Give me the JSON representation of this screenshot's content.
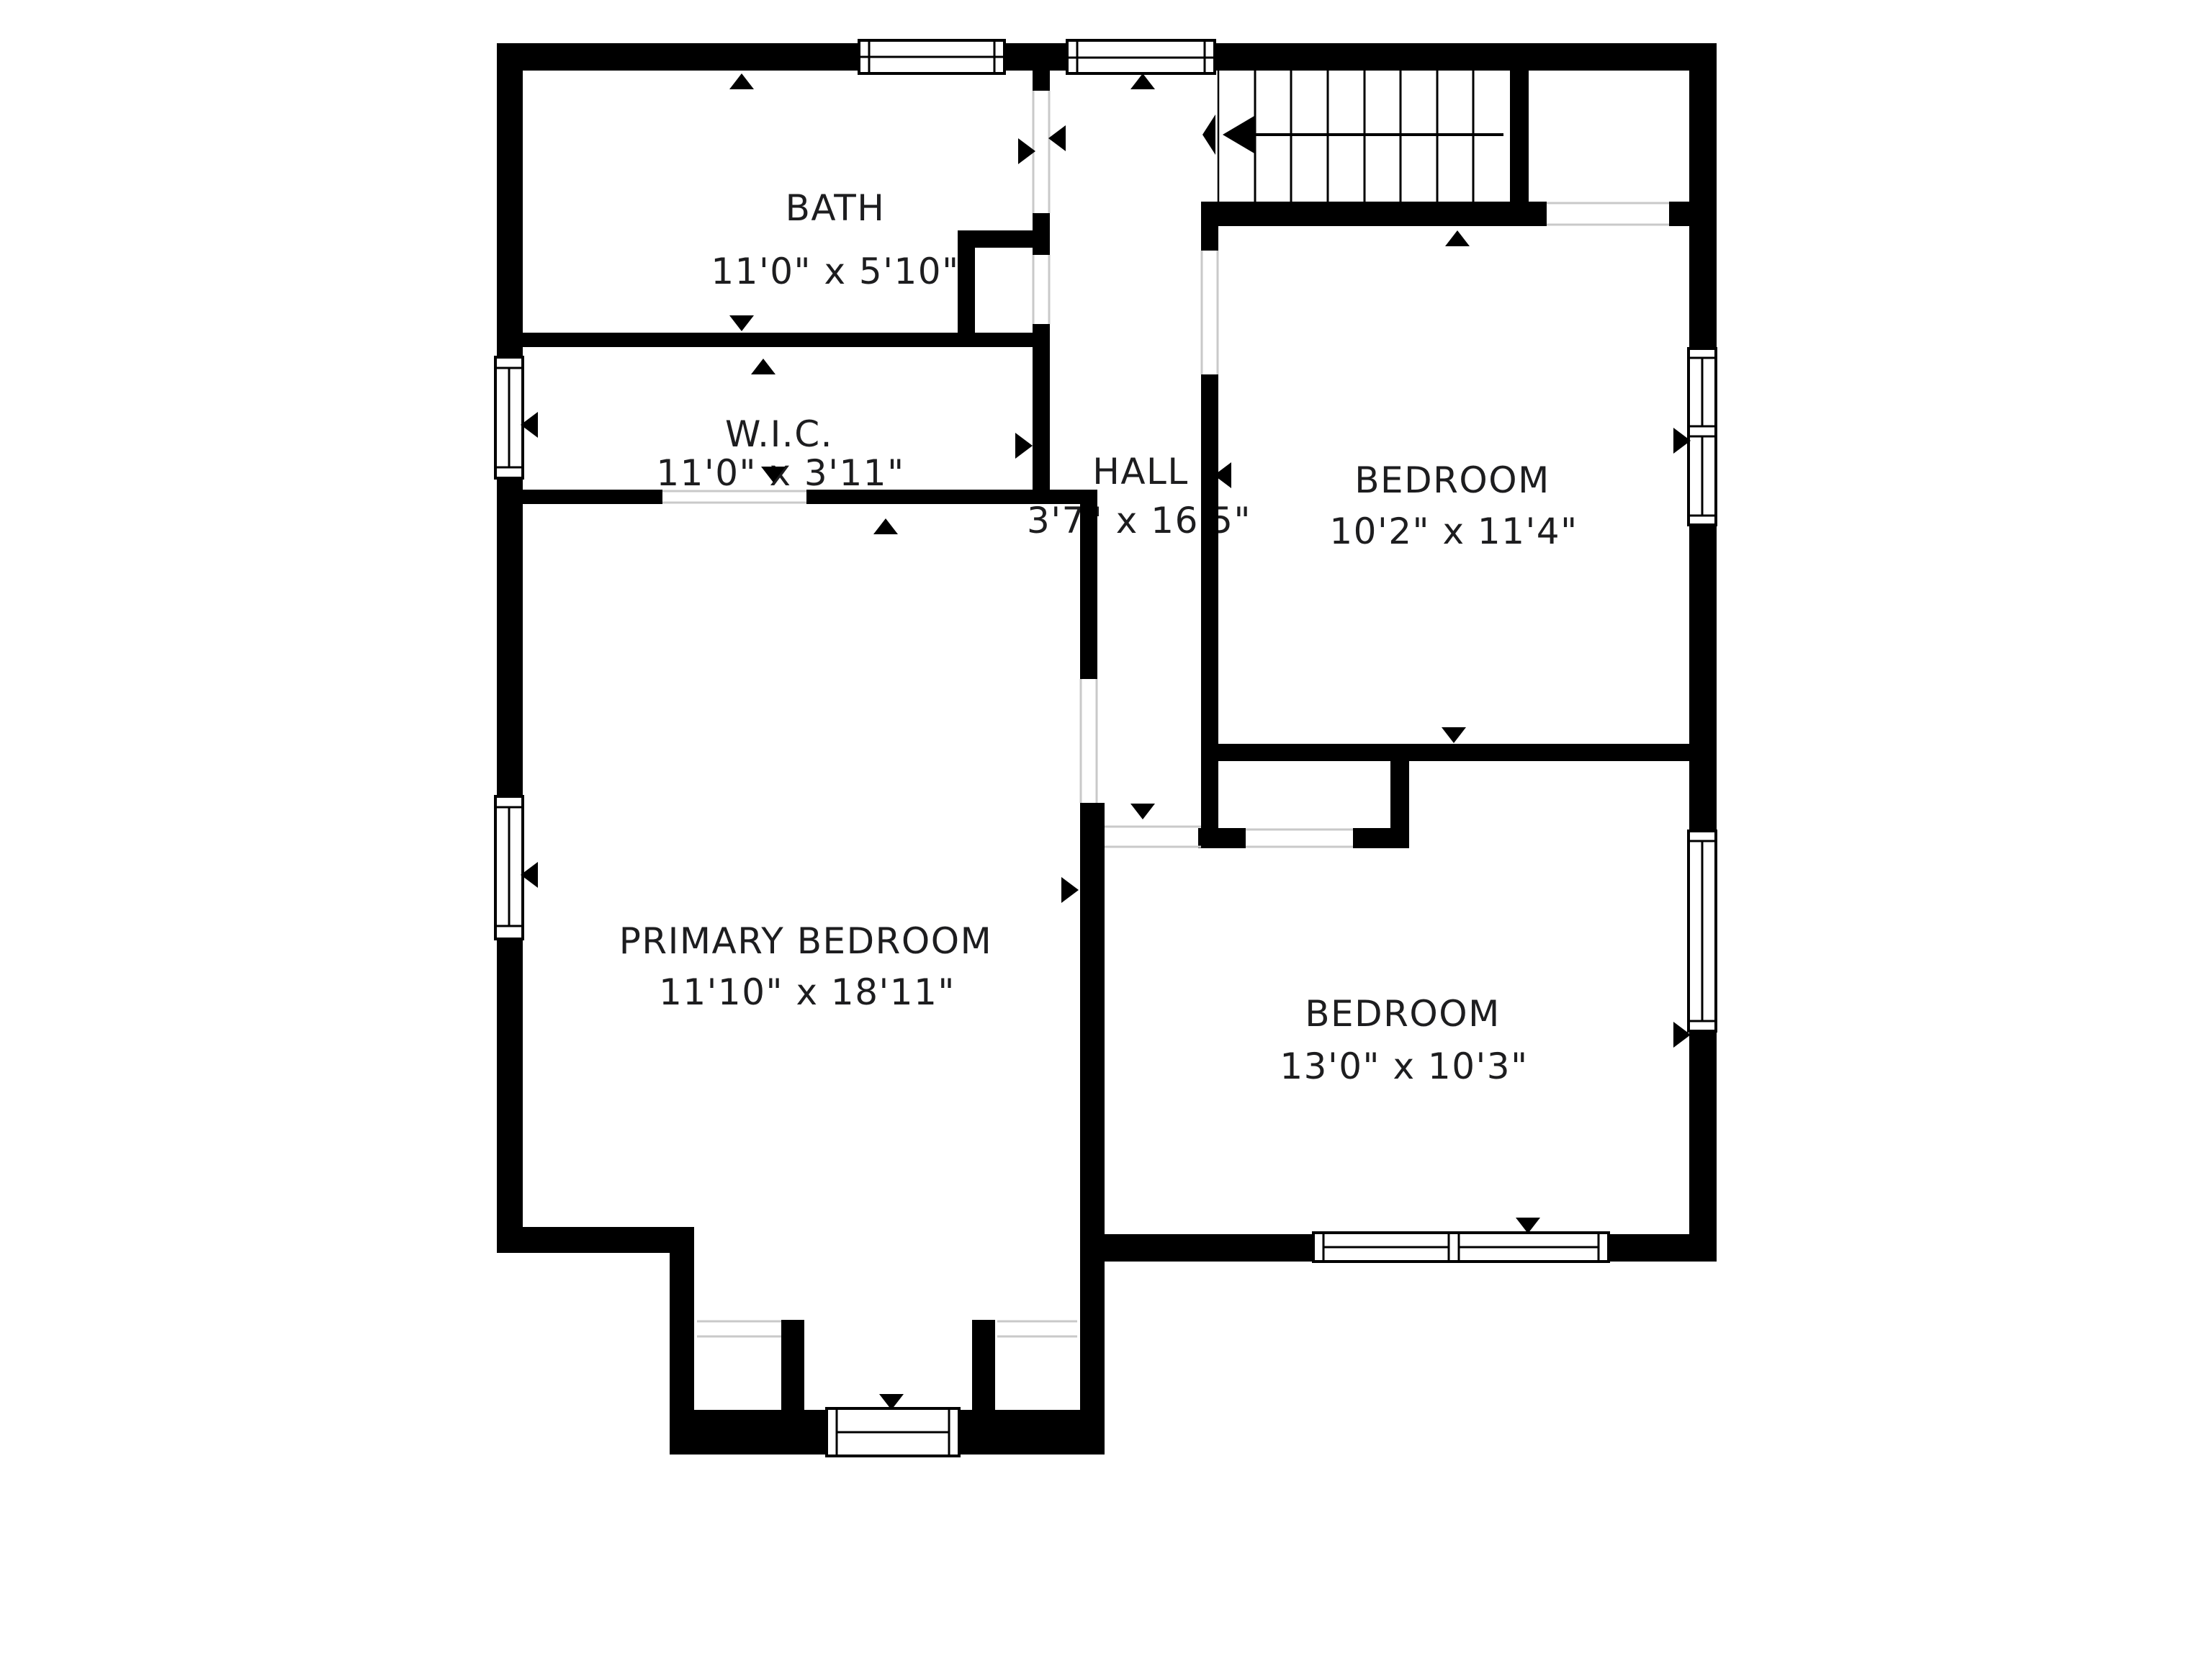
{
  "plan": {
    "type": "floor-plan",
    "floor_label": "",
    "wall_color": "#000000",
    "text_color": "#1d1d1f",
    "background_color": "#ffffff",
    "rooms": [
      {
        "name": "BATH",
        "dimensions": "11'0\" x 5'10\""
      },
      {
        "name": "W.I.C.",
        "dimensions": "11'0\" x 3'11\""
      },
      {
        "name": "HALL",
        "dimensions": "3'7\" x 16'5\""
      },
      {
        "name": "BEDROOM",
        "dimensions": "10'2\" x 11'4\""
      },
      {
        "name": "PRIMARY BEDROOM",
        "dimensions": "11'10\" x 18'11\""
      },
      {
        "name": "BEDROOM",
        "dimensions": "13'0\" x 10'3\""
      }
    ],
    "stairs": {
      "treads": 8,
      "direction": "down-to-left"
    }
  }
}
